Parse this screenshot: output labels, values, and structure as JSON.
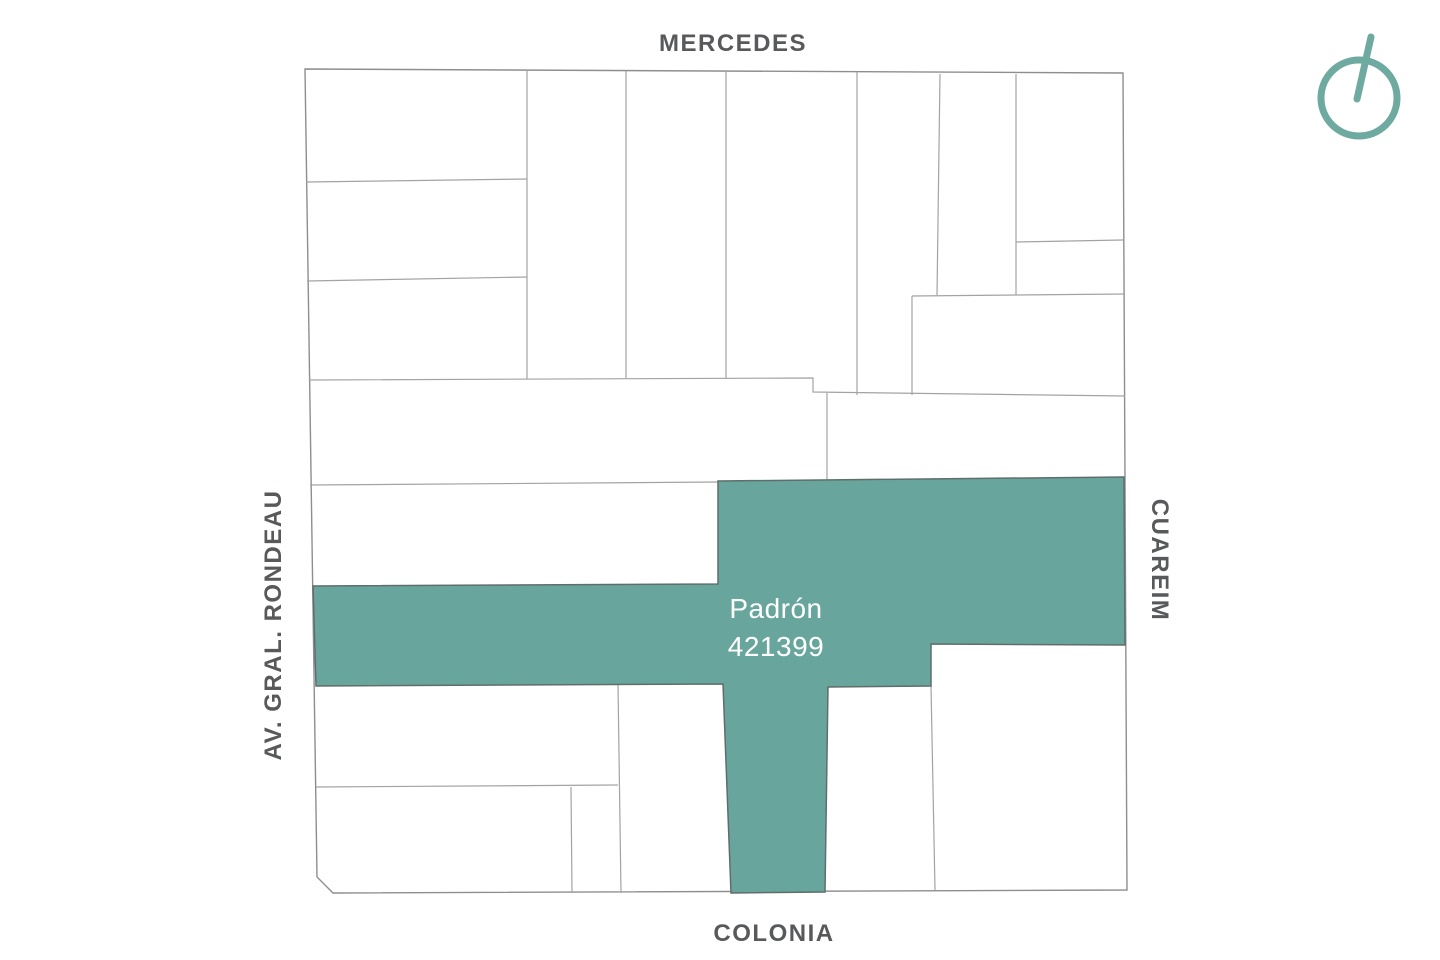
{
  "streets": {
    "top": "MERCEDES",
    "bottom": "COLONIA",
    "left": "AV. GRAL. RONDEAU",
    "right": "CUAREIM"
  },
  "parcel": {
    "label_title": "Padrón",
    "number": "421399"
  },
  "icons": {
    "compass": "north-compass-icon"
  },
  "colors": {
    "background": "#FFFFFF",
    "parcel-fill": "#68A69D",
    "parcel-stroke": "#5F6E6B",
    "line": "#A3A3A3",
    "outline": "#8E8E8E",
    "street-text": "#58595B",
    "compass": "#6FAAA0",
    "parcel-text": "#FFFFFF"
  }
}
